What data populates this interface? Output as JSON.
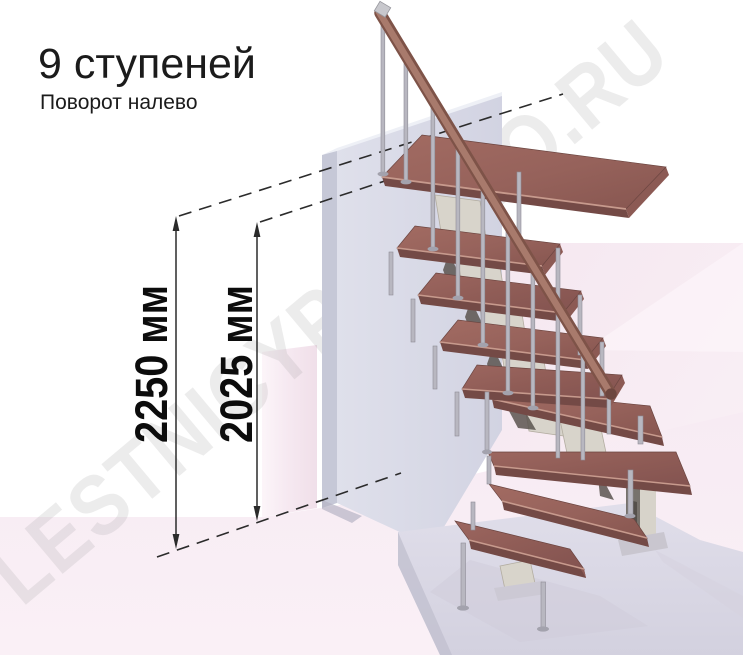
{
  "title": {
    "heading": "9 ступеней",
    "subtitle": "Поворот налево"
  },
  "watermark": {
    "text": "LESTNICYPROSTO.RU"
  },
  "annotations": {
    "dimensions": [
      {
        "id": "floor-to-landing",
        "label": "2250 мм"
      },
      {
        "id": "floor-to-top-step",
        "label": "2025 мм"
      }
    ],
    "reference_lines": [
      "landing-level",
      "top-step-level",
      "floor-level"
    ]
  },
  "scene": {
    "steps_count": 9,
    "turn_direction": "left",
    "elements": [
      "wooden-treads",
      "metal-balusters",
      "wooden-handrail",
      "landing-wall",
      "support-column",
      "base-platform"
    ],
    "colors": {
      "tread_wood": "#99655e",
      "tread_wood_dark": "#744a46",
      "handrail_wood": "#a07263",
      "metal": "#b8b7c0",
      "stringer_cream": "#d8d4cb",
      "landing_wall": "#d9dae7",
      "base_platform": "#dcdae6",
      "floor_pink": "#f8edf4",
      "right_wall_pink": "#f7eaf2",
      "annotation": "#2b2b2b",
      "text": "#1b1b1b"
    }
  }
}
